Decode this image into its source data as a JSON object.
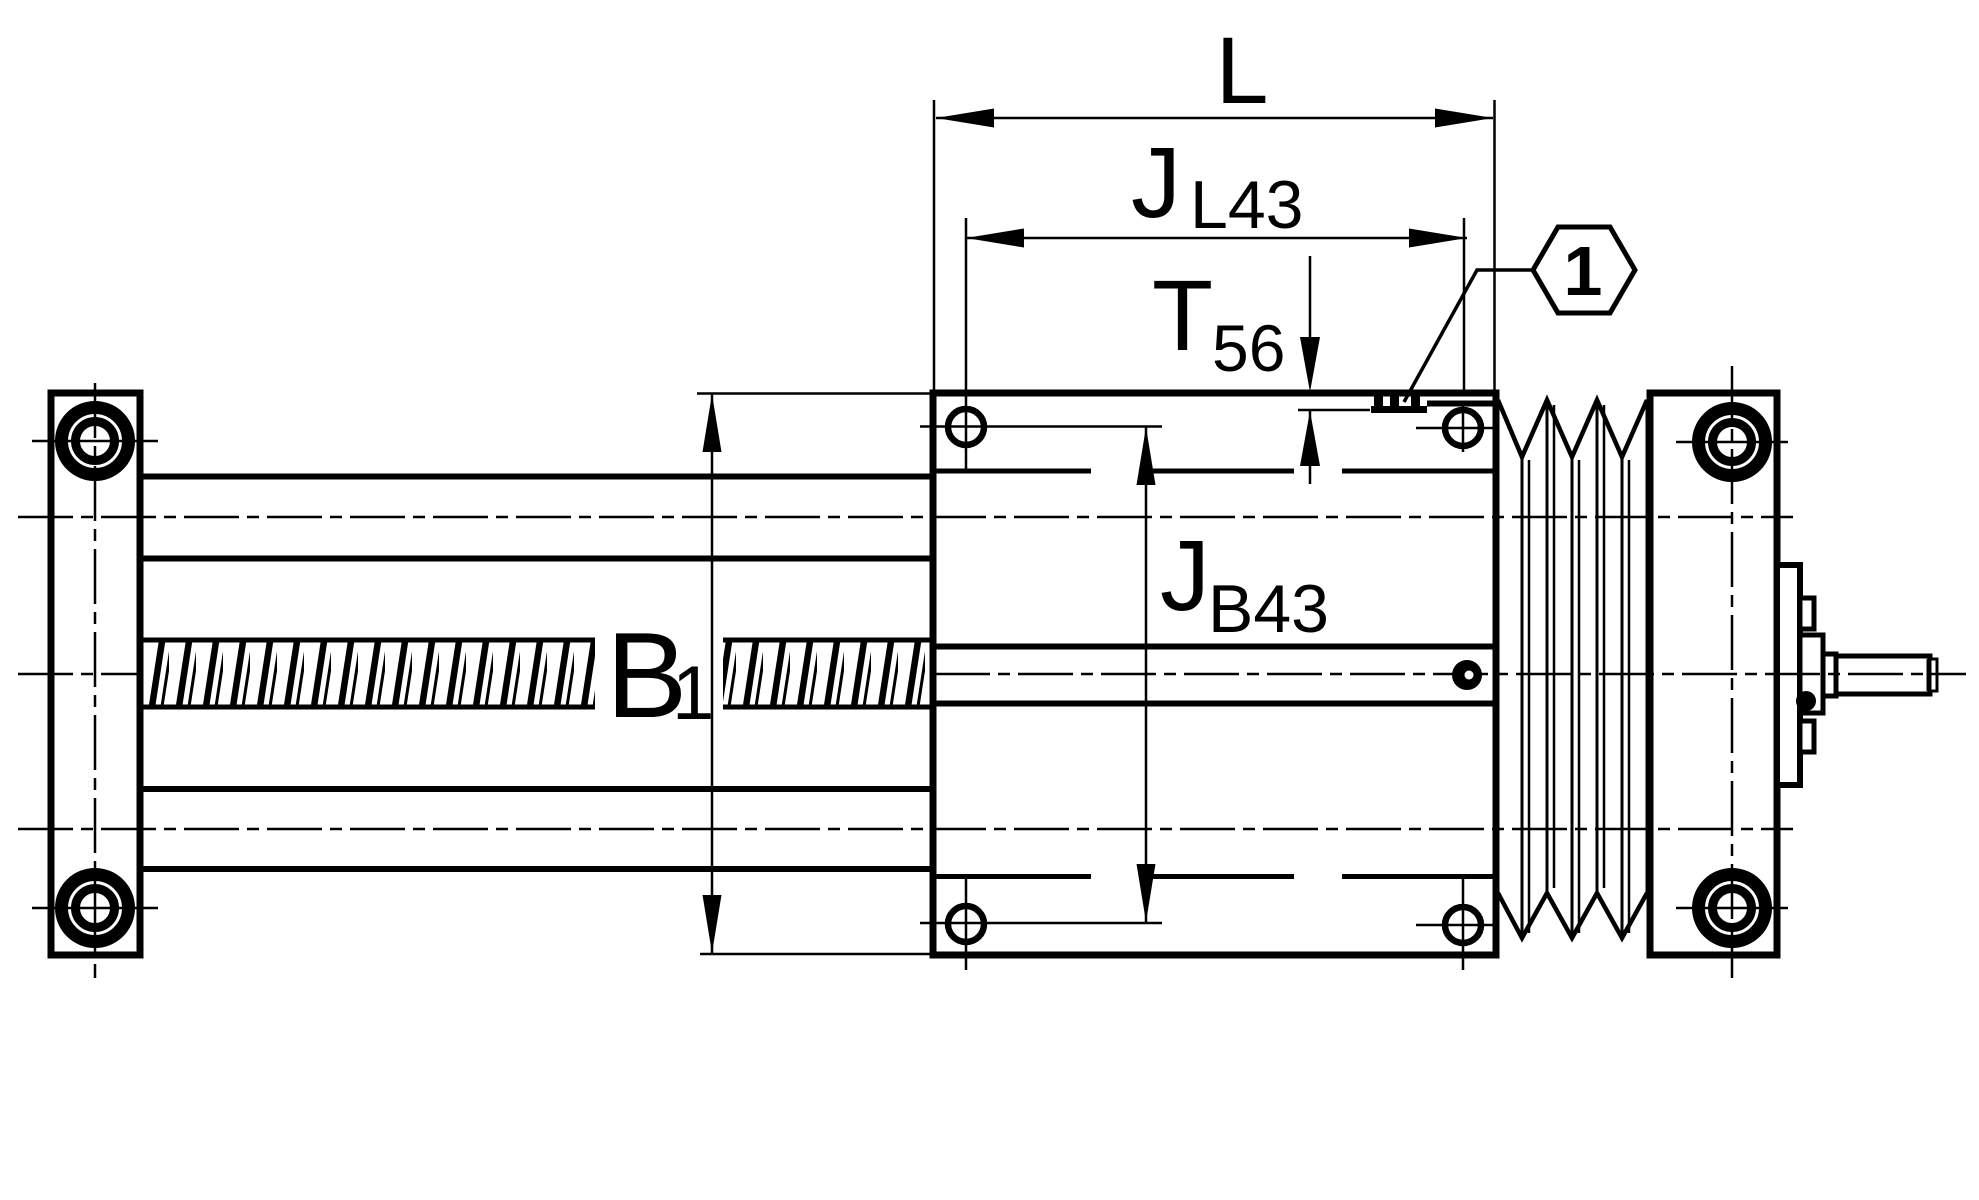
{
  "drawing": {
    "background": "#ffffff",
    "ink": "#000000",
    "dimensions": {
      "L": {
        "label": "L"
      },
      "JL43": {
        "base": "J",
        "sub": "L43"
      },
      "T56": {
        "base": "T",
        "sub": "56"
      },
      "B1": {
        "base": "B",
        "sub": "1"
      },
      "JB43": {
        "base": "J",
        "sub": "B43"
      }
    },
    "callout": {
      "number": "1"
    }
  }
}
